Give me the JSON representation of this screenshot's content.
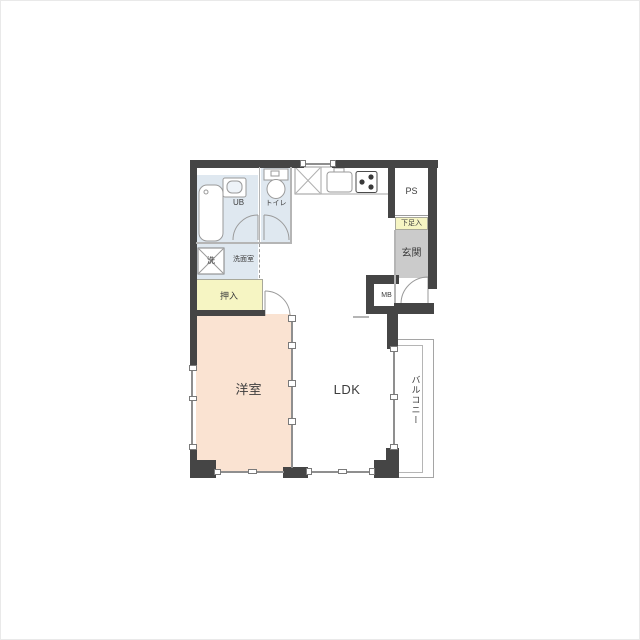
{
  "plan": {
    "type": "floor-plan",
    "rooms": {
      "unit_bath": "UB",
      "toilet": "トイレ",
      "washroom": "洗面室",
      "washer": "洗",
      "closet": "押入",
      "western_room": "洋室",
      "ldk": "LDK",
      "entrance": "玄関",
      "shoe_cabinet": "下足入",
      "pipe_space": "PS",
      "meter_box": "MB",
      "balcony": "バルコニー"
    },
    "colors": {
      "wall": "#454545",
      "water_rooms_fill": "#dfe8f0",
      "closet_fill": "#f6f5c3",
      "shoe_cabinet_fill": "#f6f5c3",
      "entrance_fill": "#cbcbcb",
      "western_room_fill": "#fae3d2",
      "ldk_fill": "#ffffff",
      "line": "#8f8f8f"
    }
  }
}
